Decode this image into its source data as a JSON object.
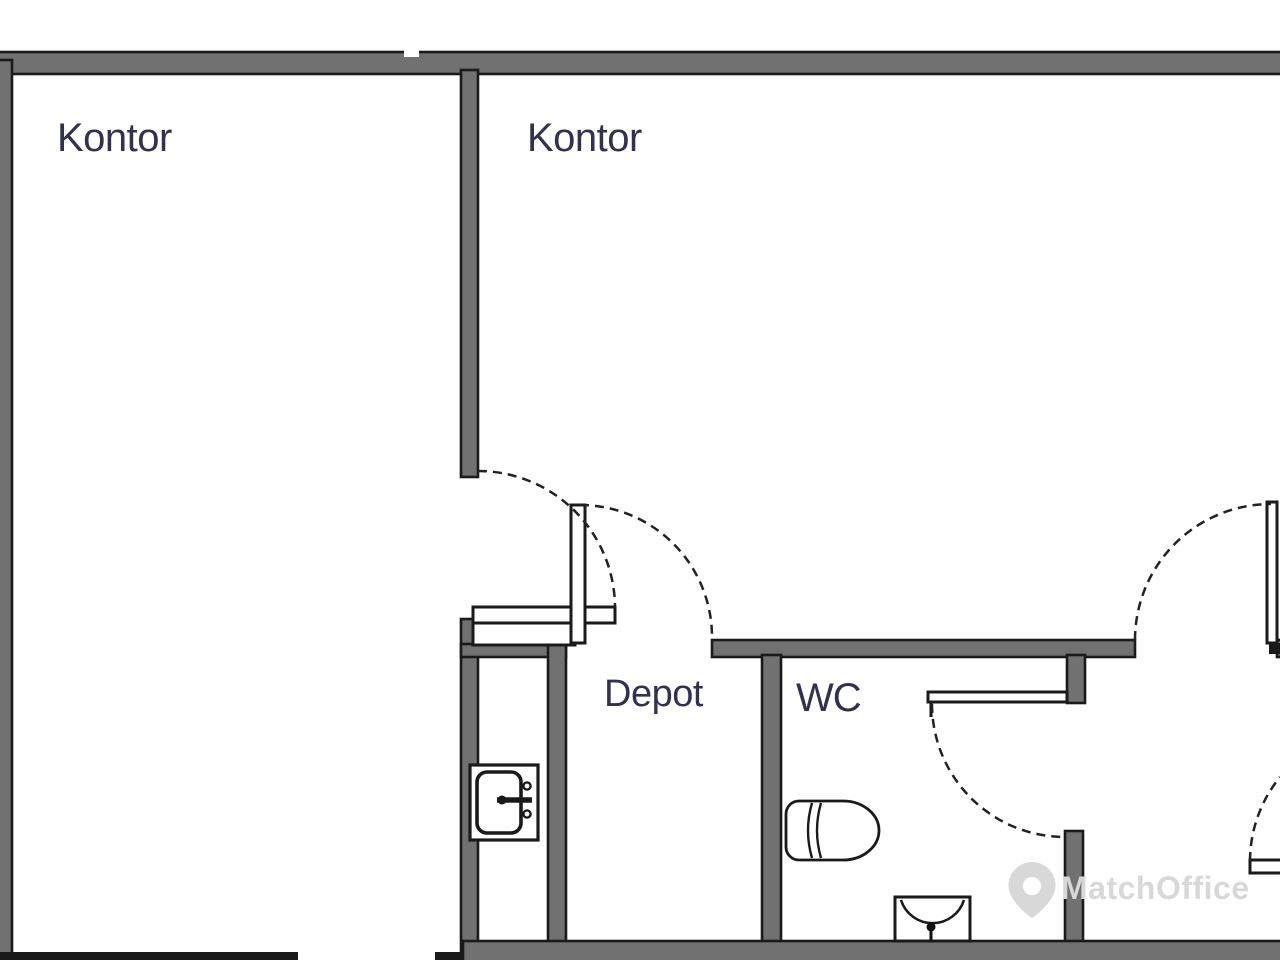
{
  "floorplan": {
    "type": "office-floor-plan",
    "rooms": [
      {
        "name": "kontor-left",
        "label": "Kontor"
      },
      {
        "name": "kontor-right",
        "label": "Kontor"
      },
      {
        "name": "depot",
        "label": "Depot"
      },
      {
        "name": "wc",
        "label": "WC"
      }
    ],
    "fixtures": [
      {
        "name": "kitchen-sink-icon"
      },
      {
        "name": "toilet-icon"
      },
      {
        "name": "hand-basin-icon"
      }
    ],
    "door_swings": 5,
    "watermark": {
      "text": "MatchOffice",
      "icon": "map-pin-icon"
    },
    "colors": {
      "wall_fill": "#717171",
      "line": "#1a1a1a",
      "label": "#32324e",
      "watermark": "#d8d8d8",
      "background": "#ffffff"
    }
  }
}
